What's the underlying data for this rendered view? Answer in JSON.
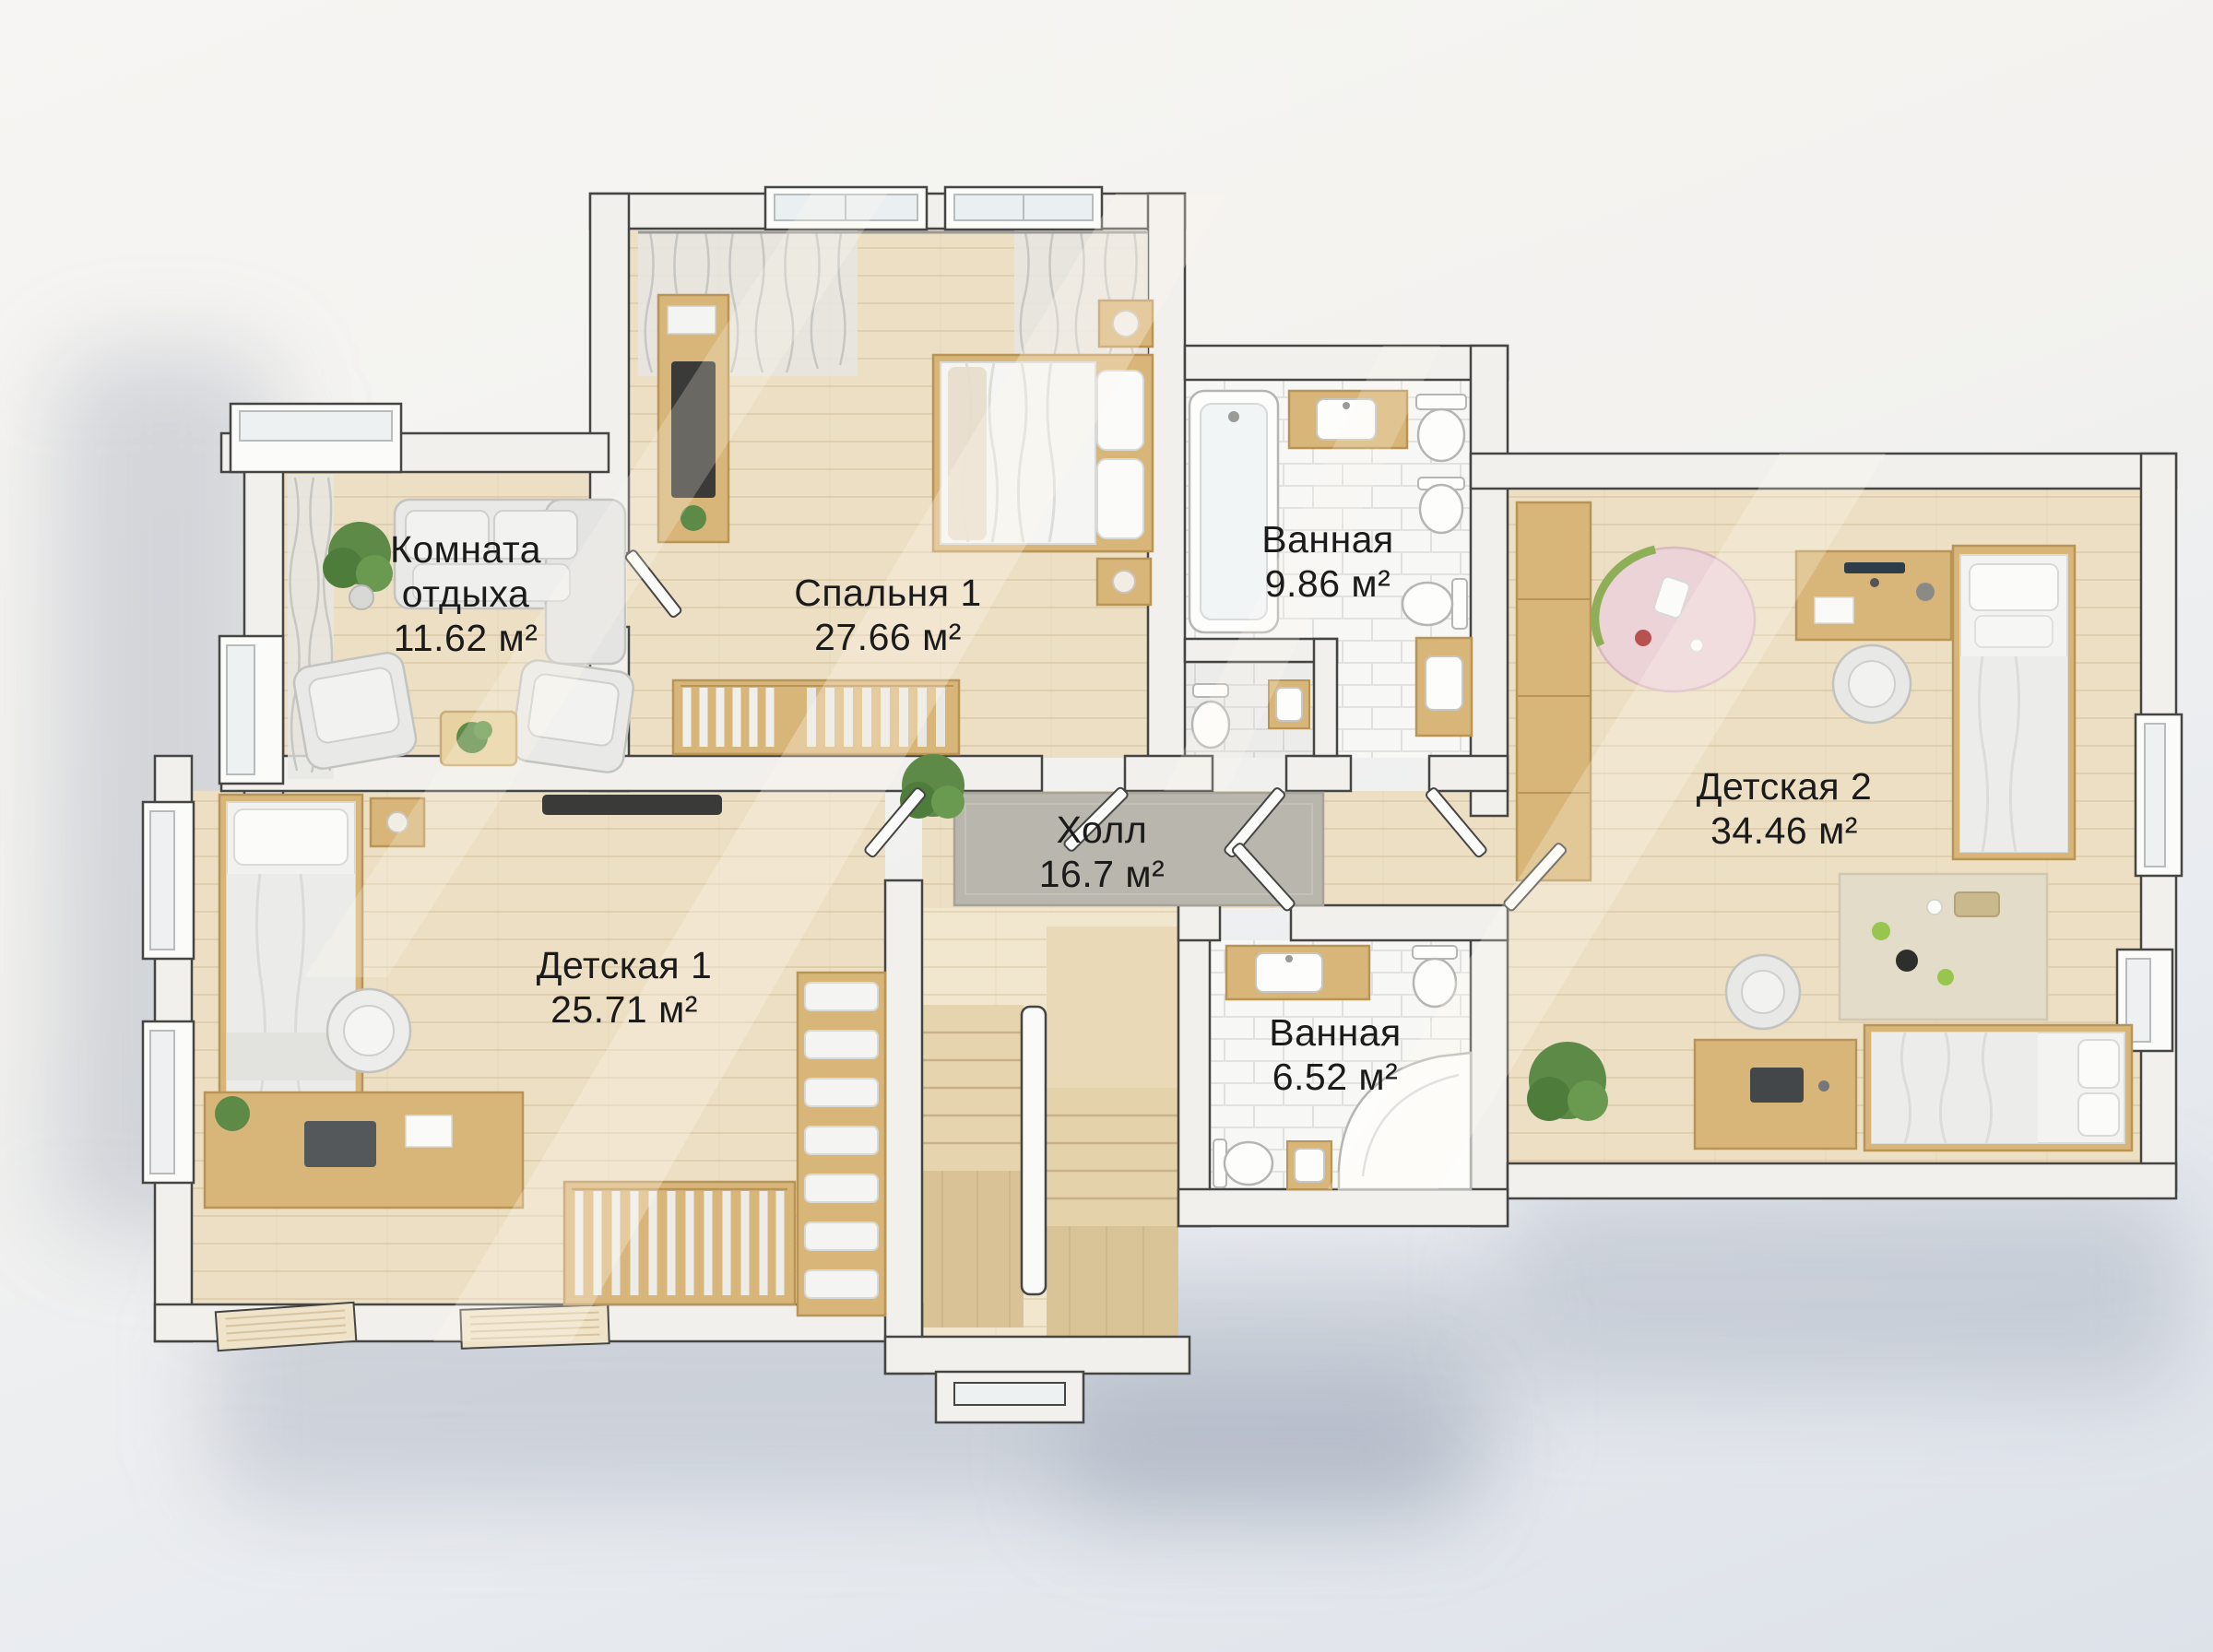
{
  "plan": {
    "type": "floor-plan",
    "language": "ru",
    "units": "м²"
  },
  "rooms": [
    {
      "key": "rest-room",
      "name": "Комната отдыха",
      "area": "11.62 м²"
    },
    {
      "key": "bedroom-1",
      "name": "Спальня 1",
      "area": "27.66 м²"
    },
    {
      "key": "bathroom-1",
      "name": "Ванная",
      "area": "9.86 м²"
    },
    {
      "key": "nursery-2",
      "name": "Детская 2",
      "area": "34.46 м²"
    },
    {
      "key": "hall",
      "name": "Холл",
      "area": "16.7 м²"
    },
    {
      "key": "nursery-1",
      "name": "Детская 1",
      "area": "25.71 м²"
    },
    {
      "key": "bathroom-2",
      "name": "Ванная",
      "area": "6.52 м²"
    }
  ],
  "colors": {
    "background_top": "#f6f5f3",
    "background_shadow": "#dde2e9",
    "wall_fill": "#f1f0ec",
    "wall_outline": "#454543",
    "floor_wood": "#ecdfc4",
    "floor_wood_line": "#d9c6a3",
    "tile": "#f7f7f5",
    "tile_line": "#dcdcd8",
    "stairs_wood": "#e8d6b0",
    "furniture_wood": "#d8b679",
    "fabric_gray": "#e9e9e7",
    "rug_gray": "#b9b6ae",
    "play_mat_pink": "#ecd3d8",
    "plant_green": "#5d8a46",
    "label_text": "#1b1b1b"
  }
}
